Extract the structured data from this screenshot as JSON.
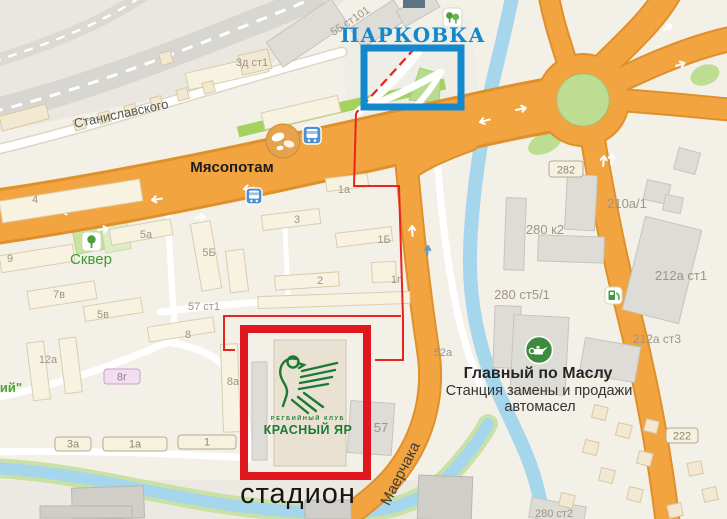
{
  "annotations": {
    "parking_label": "ПАРКОВКА",
    "stadium_label": "стадион",
    "parking_color": "#1488cc",
    "stadium_box_color": "#e0171e",
    "route_color": "#e8241f"
  },
  "pois": {
    "myasopotam_label": "Мясопотам",
    "skver_label": "Сквер",
    "oil_title": "Главный по Маслу",
    "oil_sub1": "Станция замены и продажи",
    "oil_sub2": "автомасел",
    "logo_line1": "РЕГБИЙНЫЙ КЛУБ",
    "logo_line2": "КРАСНЫЙ ЯР"
  },
  "streets": {
    "stanislavskogo": "Станиславского",
    "maerchaka": "Маерчака"
  },
  "map": {
    "labels": [
      {
        "t": "3д ст1",
        "x": 252,
        "y": 66
      },
      {
        "t": "55 ст101",
        "x": 352,
        "y": 24,
        "r": -33
      },
      {
        "t": "4",
        "x": 35,
        "y": 203
      },
      {
        "t": "9",
        "x": 10,
        "y": 262
      },
      {
        "t": "5а",
        "x": 146,
        "y": 238
      },
      {
        "t": "5Б",
        "x": 209,
        "y": 256
      },
      {
        "t": "7в",
        "x": 59,
        "y": 298
      },
      {
        "t": "5в",
        "x": 103,
        "y": 318
      },
      {
        "t": "8",
        "x": 188,
        "y": 338
      },
      {
        "t": "12а",
        "x": 48,
        "y": 363
      },
      {
        "t": "8а",
        "x": 233,
        "y": 385
      },
      {
        "t": "3",
        "x": 297,
        "y": 223
      },
      {
        "t": "1а",
        "x": 344,
        "y": 193
      },
      {
        "t": "1Б",
        "x": 384,
        "y": 243
      },
      {
        "t": "2",
        "x": 320,
        "y": 284
      },
      {
        "t": "1г",
        "x": 396,
        "y": 283
      },
      {
        "t": "57 ст1",
        "x": 204,
        "y": 310
      },
      {
        "t": "57",
        "x": 381,
        "y": 432,
        "s": 13
      },
      {
        "t": "52а",
        "x": 443,
        "y": 356
      },
      {
        "t": "280 к2",
        "x": 545,
        "y": 234,
        "s": 13
      },
      {
        "t": "280 ст5/1",
        "x": 522,
        "y": 299,
        "s": 13
      },
      {
        "t": "210а/1",
        "x": 627,
        "y": 208,
        "s": 13
      },
      {
        "t": "212а ст1",
        "x": 681,
        "y": 280,
        "s": 13
      },
      {
        "t": "212а ст3",
        "x": 657,
        "y": 343,
        "s": 12
      },
      {
        "t": "280 ст2",
        "x": 554,
        "y": 517
      },
      {
        "t": "ий\"",
        "x": 11,
        "y": 392,
        "c": "#50a52d",
        "b": true,
        "s": 13
      }
    ],
    "plates": [
      {
        "text": "3а",
        "x": 55,
        "y": 437,
        "w": 36,
        "h": 14
      },
      {
        "text": "1а",
        "x": 103,
        "y": 437,
        "w": 64,
        "h": 14
      },
      {
        "text": "1",
        "x": 178,
        "y": 435,
        "w": 58,
        "h": 14
      },
      {
        "text": "282",
        "x": 549,
        "y": 161,
        "w": 34,
        "h": 16
      },
      {
        "text": "222",
        "x": 666,
        "y": 428,
        "w": 32,
        "h": 15
      },
      {
        "text": "8г",
        "x": 104,
        "y": 369,
        "w": 36,
        "h": 15,
        "fill": "#f2ddf1",
        "stroke": "#c9a3c6",
        "color": "#8f7d92"
      }
    ]
  }
}
